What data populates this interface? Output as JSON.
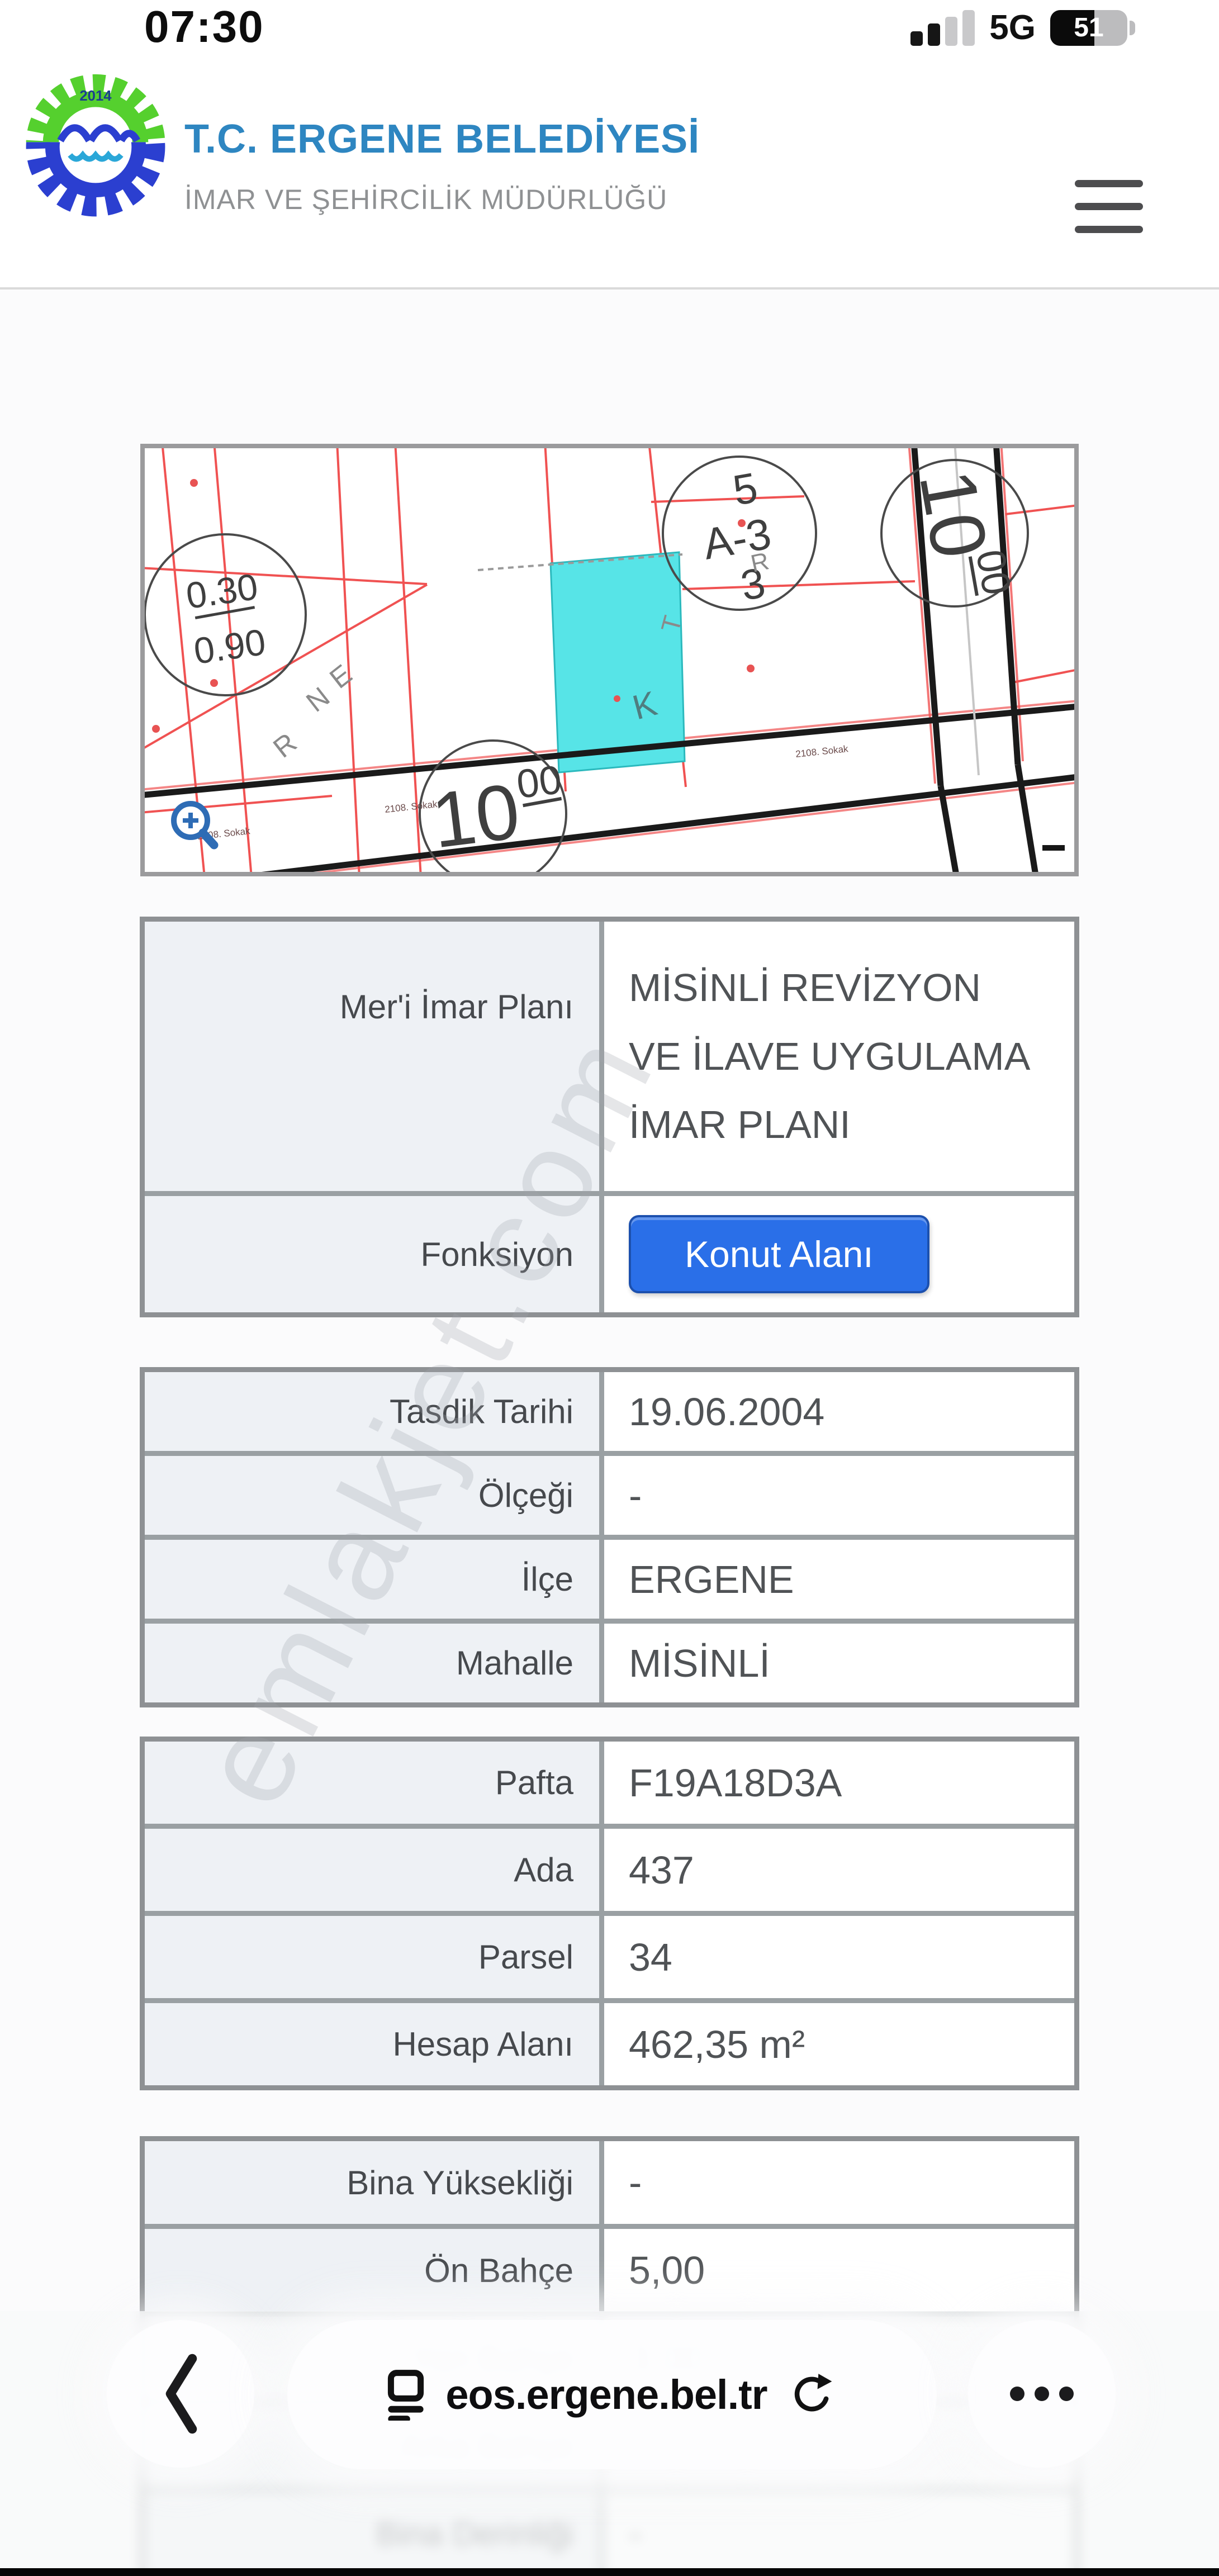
{
  "status_bar": {
    "time": "07:30",
    "network": "5G",
    "battery": "51"
  },
  "header": {
    "title": "T.C. ERGENE BELEDİYESİ",
    "subtitle": "İMAR VE ŞEHİRCİLİK MÜDÜRLÜĞÜ",
    "logo_year": "2014"
  },
  "map": {
    "ratio_top": "0.30",
    "ratio_bottom": "0.90",
    "block_top": "5",
    "block_mid": "A-3",
    "block_bottom": "3",
    "road_right_main": "10",
    "road_right_sup": "00",
    "road_bottom_main": "10",
    "road_bottom_sup": "00",
    "parcel_letter": "K",
    "letter_e": "E",
    "letter_n": "N",
    "letter_r1": "R",
    "letter_r2": "R",
    "letter_t": "T",
    "street1": "2108. Sokak",
    "street2": "2108. Sokak",
    "street3": "2108. Sokak",
    "dash": "-"
  },
  "watermark": "emlakjet.com",
  "tables": [
    {
      "rows": [
        {
          "label": "Mer'i İmar Planı",
          "value": "MİSİNLİ REVİZYON VE İLAVE UYGULAMA İMAR PLANI"
        },
        {
          "label": "Fonksiyon",
          "value": "Konut Alanı"
        }
      ]
    },
    {
      "rows": [
        {
          "label": "Tasdik Tarihi",
          "value": "19.06.2004"
        },
        {
          "label": "Ölçeği",
          "value": "-"
        },
        {
          "label": "İlçe",
          "value": "ERGENE"
        },
        {
          "label": "Mahalle",
          "value": "MİSİNLİ"
        }
      ]
    },
    {
      "rows": [
        {
          "label": "Pafta",
          "value": "F19A18D3A"
        },
        {
          "label": "Ada",
          "value": "437"
        },
        {
          "label": "Parsel",
          "value": "34"
        },
        {
          "label": "Hesap Alanı",
          "value": "462,35 m²"
        }
      ]
    },
    {
      "rows": [
        {
          "label": "Bina Yüksekliği",
          "value": "-"
        },
        {
          "label": "Ön Bahçe",
          "value": "5,00"
        },
        {
          "label": "Yan Bahçe",
          "value": "3,00"
        },
        {
          "label": "Arka Bahçe",
          "value": ""
        },
        {
          "label": "Bina Derinliği",
          "value": "-"
        }
      ]
    }
  ],
  "toolbar": {
    "url": "eos.ergene.bel.tr"
  },
  "colors": {
    "accent_blue": "#2e86c1",
    "button_blue": "#2a6fe8",
    "parcel_cyan": "#57e4e7",
    "line_red": "#f05252",
    "border_gray": "#8e9194"
  }
}
